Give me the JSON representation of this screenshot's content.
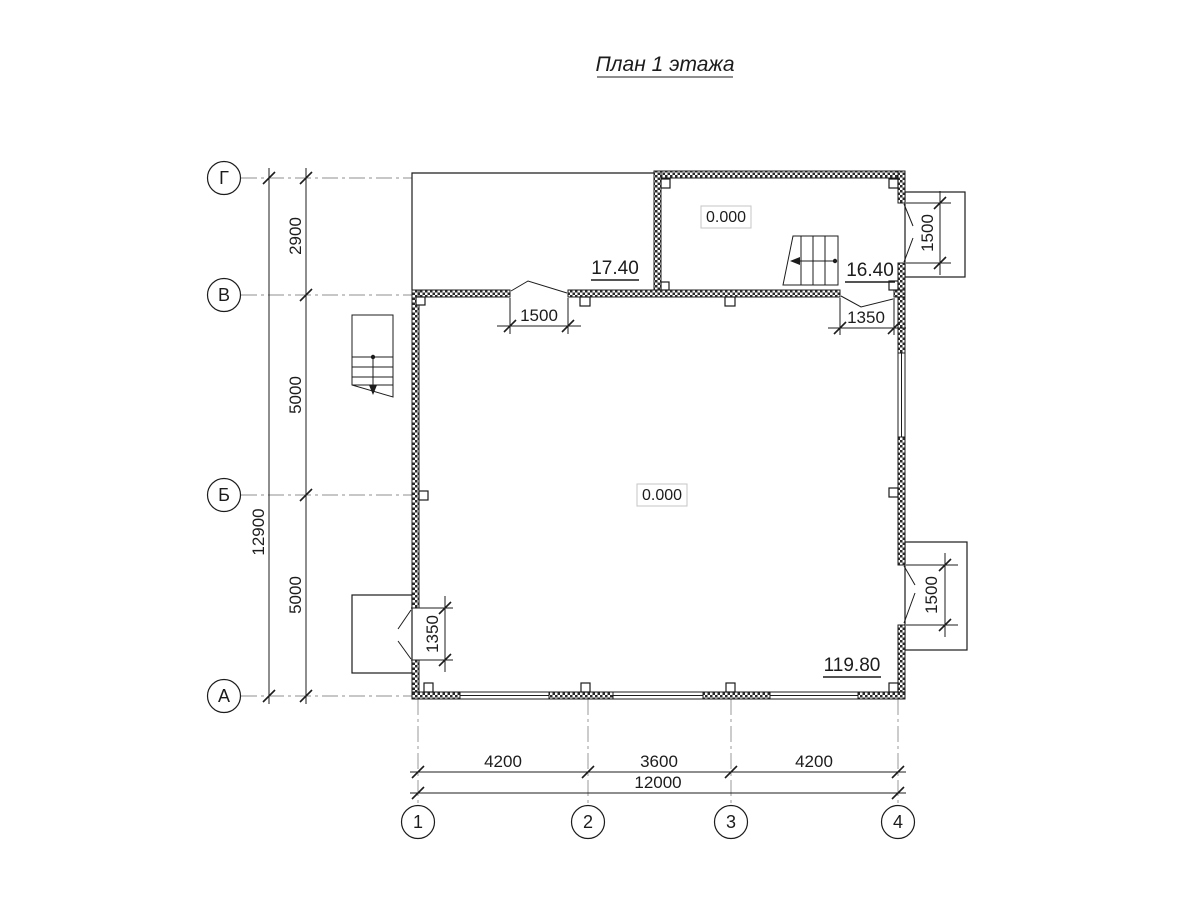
{
  "title": "План 1 этажа",
  "axes": {
    "rows": [
      {
        "label": "Г"
      },
      {
        "label": "В"
      },
      {
        "label": "Б"
      },
      {
        "label": "А"
      }
    ],
    "cols": [
      {
        "label": "1"
      },
      {
        "label": "2"
      },
      {
        "label": "3"
      },
      {
        "label": "4"
      }
    ]
  },
  "dims": {
    "left": {
      "segments": [
        "2900",
        "5000",
        "5000"
      ],
      "total": "12900"
    },
    "bottom": {
      "segments": [
        "4200",
        "3600",
        "4200"
      ],
      "total": "12000"
    },
    "openings": {
      "entry_door": "1500",
      "right_door": "1350",
      "left_door": "1350",
      "upper_balcony": "1500",
      "lower_balcony": "1500"
    }
  },
  "levels": {
    "upper_room": "0.000",
    "main_room": "0.000"
  },
  "areas": {
    "terrace": "17.40",
    "upper_room": "16.40",
    "main_room": "119.80"
  },
  "colors": {
    "line": "#1c1c1c",
    "axis_line": "#8f8f8f",
    "background": "#ffffff"
  }
}
